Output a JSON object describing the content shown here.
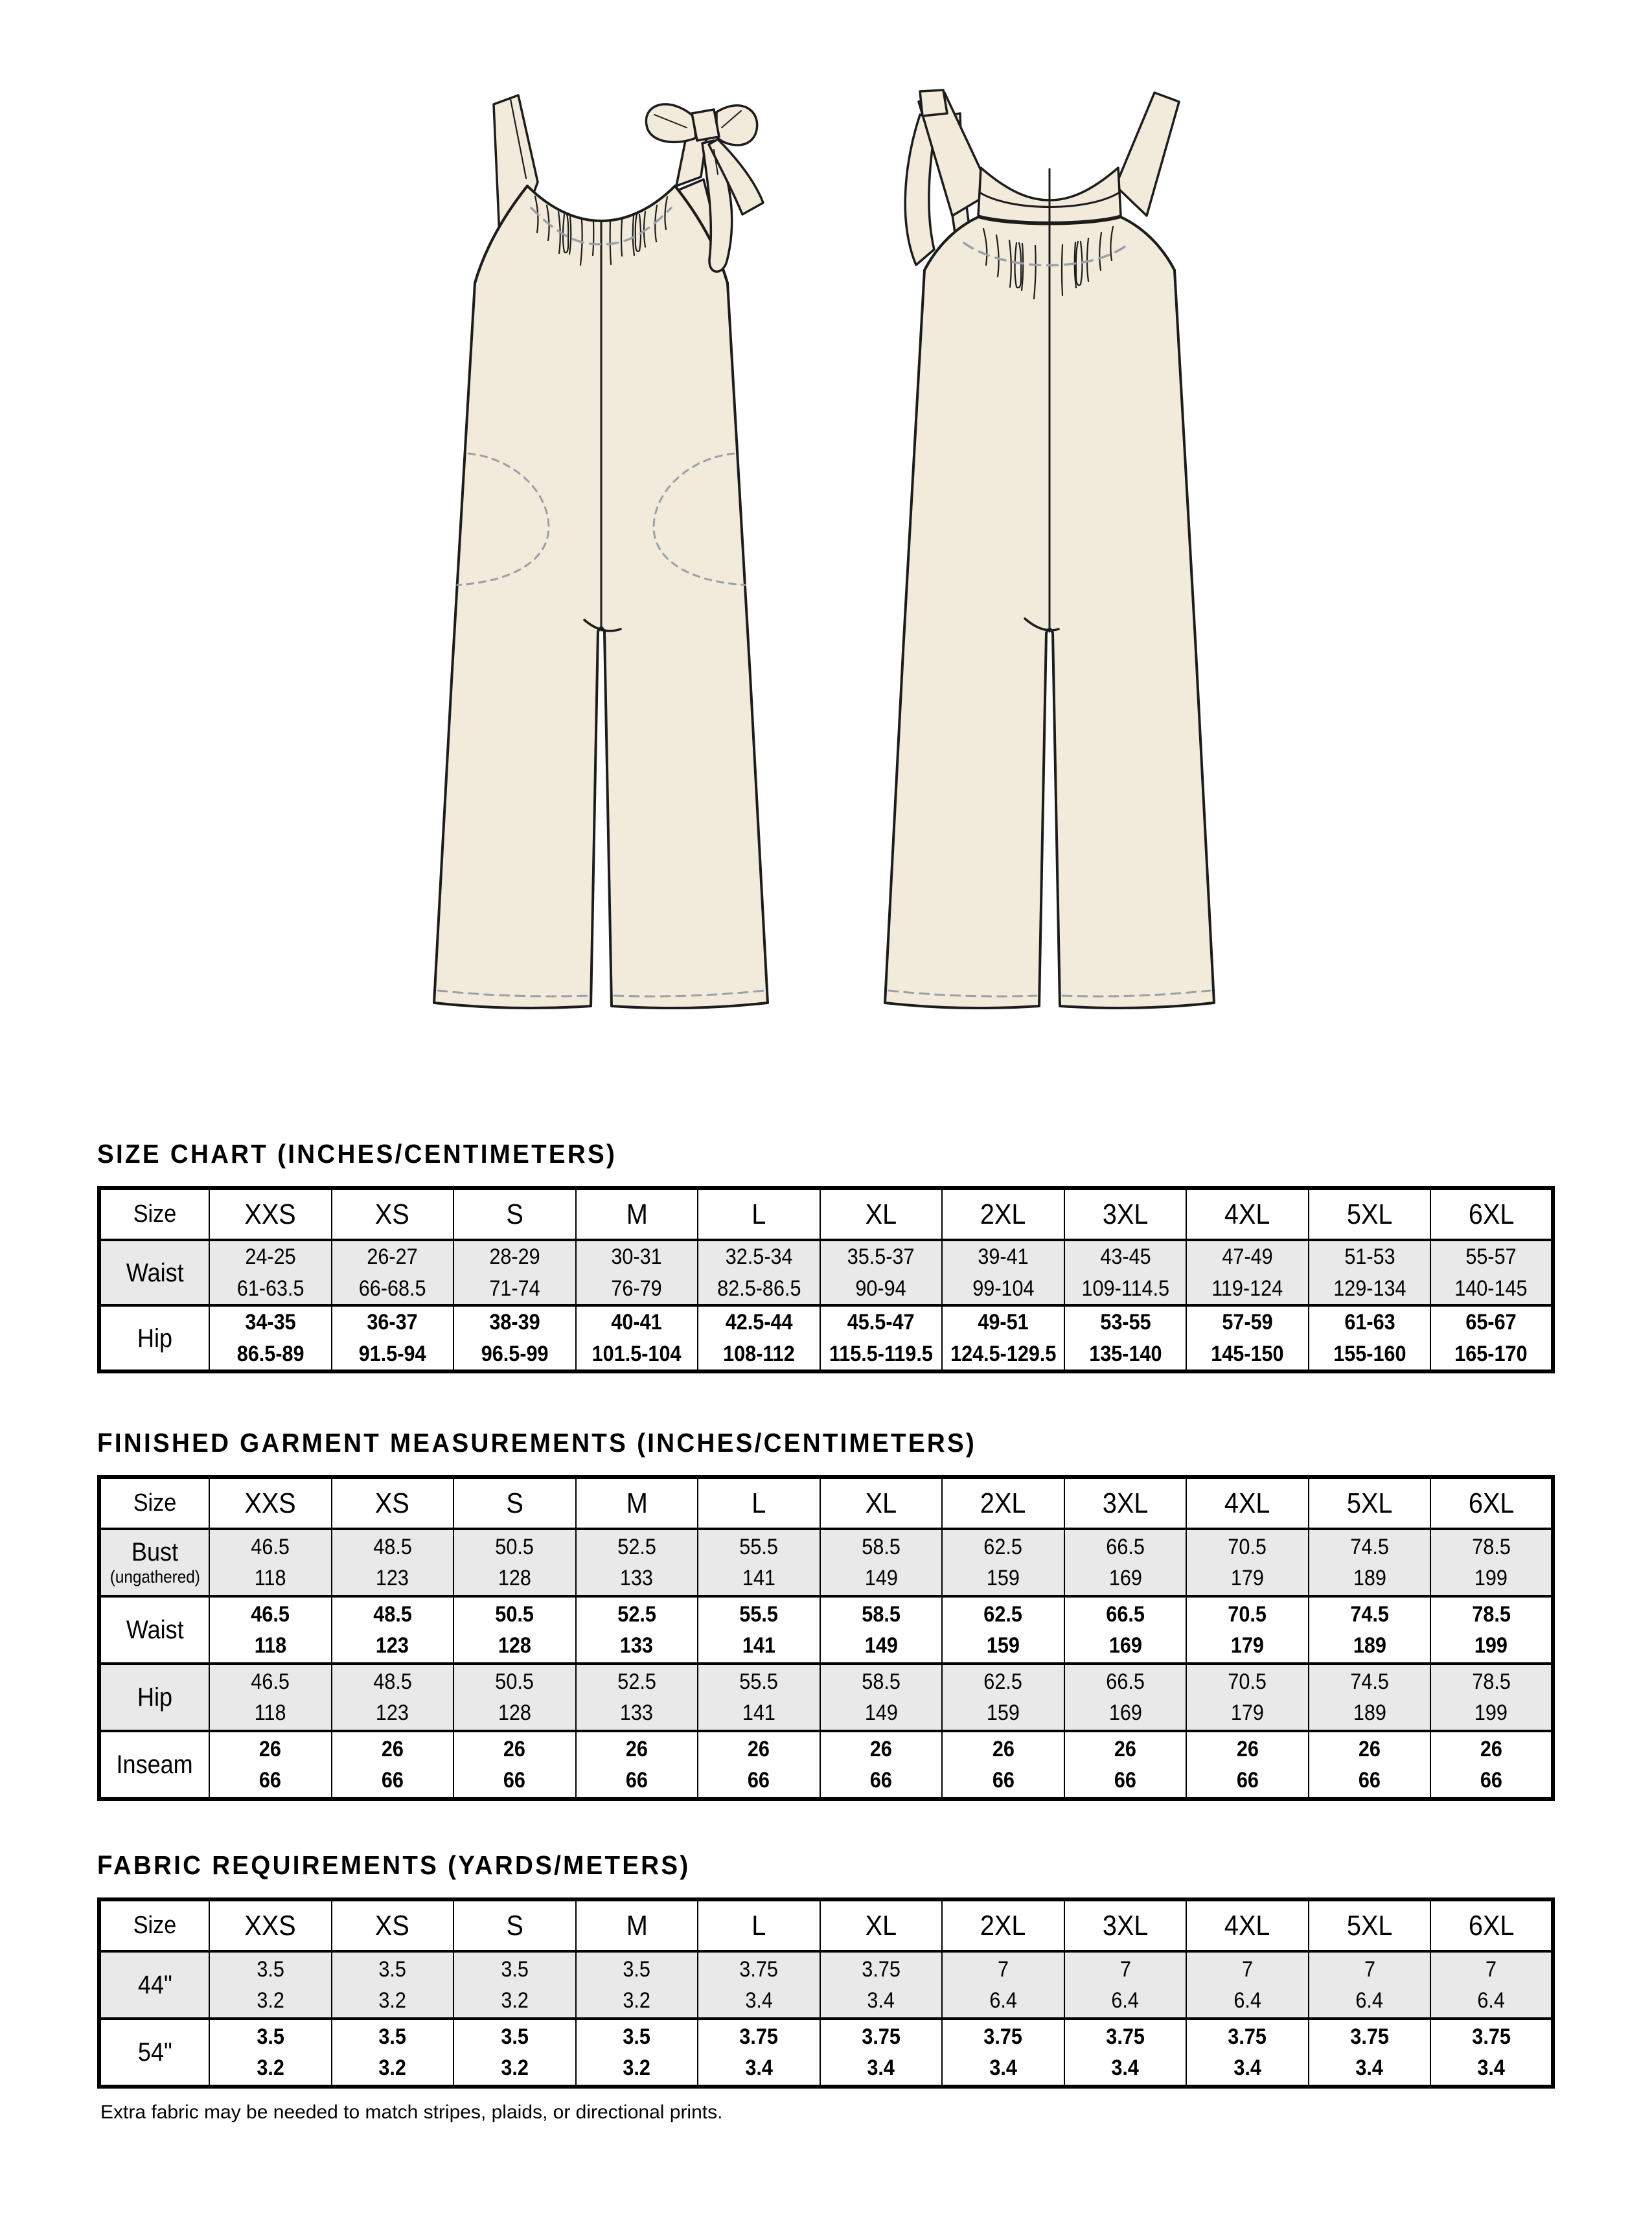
{
  "colors": {
    "fabric": "#F2EBDB",
    "outline": "#1C1C1C",
    "stitch_gray": "#98A0A8",
    "shade": "#E9E9E9"
  },
  "sizes": [
    "XXS",
    "XS",
    "S",
    "M",
    "L",
    "XL",
    "2XL",
    "3XL",
    "4XL",
    "5XL",
    "6XL"
  ],
  "size_chart": {
    "title": "SIZE CHART (INCHES/CENTIMETERS)",
    "header_label": "Size",
    "rows": [
      {
        "label": "Waist",
        "shaded": true,
        "values": [
          [
            "24-25",
            "61-63.5"
          ],
          [
            "26-27",
            "66-68.5"
          ],
          [
            "28-29",
            "71-74"
          ],
          [
            "30-31",
            "76-79"
          ],
          [
            "32.5-34",
            "82.5-86.5"
          ],
          [
            "35.5-37",
            "90-94"
          ],
          [
            "39-41",
            "99-104"
          ],
          [
            "43-45",
            "109-114.5"
          ],
          [
            "47-49",
            "119-124"
          ],
          [
            "51-53",
            "129-134"
          ],
          [
            "55-57",
            "140-145"
          ]
        ]
      },
      {
        "label": "Hip",
        "shaded": false,
        "values": [
          [
            "34-35",
            "86.5-89"
          ],
          [
            "36-37",
            "91.5-94"
          ],
          [
            "38-39",
            "96.5-99"
          ],
          [
            "40-41",
            "101.5-104"
          ],
          [
            "42.5-44",
            "108-112"
          ],
          [
            "45.5-47",
            "115.5-119.5"
          ],
          [
            "49-51",
            "124.5-129.5"
          ],
          [
            "53-55",
            "135-140"
          ],
          [
            "57-59",
            "145-150"
          ],
          [
            "61-63",
            "155-160"
          ],
          [
            "65-67",
            "165-170"
          ]
        ]
      }
    ]
  },
  "finished_garment": {
    "title": "FINISHED GARMENT MEASUREMENTS (INCHES/CENTIMETERS)",
    "header_label": "Size",
    "rows": [
      {
        "label": "Bust",
        "sublabel": "(ungathered)",
        "shaded": true,
        "values": [
          [
            "46.5",
            "118"
          ],
          [
            "48.5",
            "123"
          ],
          [
            "50.5",
            "128"
          ],
          [
            "52.5",
            "133"
          ],
          [
            "55.5",
            "141"
          ],
          [
            "58.5",
            "149"
          ],
          [
            "62.5",
            "159"
          ],
          [
            "66.5",
            "169"
          ],
          [
            "70.5",
            "179"
          ],
          [
            "74.5",
            "189"
          ],
          [
            "78.5",
            "199"
          ]
        ]
      },
      {
        "label": "Waist",
        "shaded": false,
        "values": [
          [
            "46.5",
            "118"
          ],
          [
            "48.5",
            "123"
          ],
          [
            "50.5",
            "128"
          ],
          [
            "52.5",
            "133"
          ],
          [
            "55.5",
            "141"
          ],
          [
            "58.5",
            "149"
          ],
          [
            "62.5",
            "159"
          ],
          [
            "66.5",
            "169"
          ],
          [
            "70.5",
            "179"
          ],
          [
            "74.5",
            "189"
          ],
          [
            "78.5",
            "199"
          ]
        ]
      },
      {
        "label": "Hip",
        "shaded": true,
        "values": [
          [
            "46.5",
            "118"
          ],
          [
            "48.5",
            "123"
          ],
          [
            "50.5",
            "128"
          ],
          [
            "52.5",
            "133"
          ],
          [
            "55.5",
            "141"
          ],
          [
            "58.5",
            "149"
          ],
          [
            "62.5",
            "159"
          ],
          [
            "66.5",
            "169"
          ],
          [
            "70.5",
            "179"
          ],
          [
            "74.5",
            "189"
          ],
          [
            "78.5",
            "199"
          ]
        ]
      },
      {
        "label": "Inseam",
        "shaded": false,
        "values": [
          [
            "26",
            "66"
          ],
          [
            "26",
            "66"
          ],
          [
            "26",
            "66"
          ],
          [
            "26",
            "66"
          ],
          [
            "26",
            "66"
          ],
          [
            "26",
            "66"
          ],
          [
            "26",
            "66"
          ],
          [
            "26",
            "66"
          ],
          [
            "26",
            "66"
          ],
          [
            "26",
            "66"
          ],
          [
            "26",
            "66"
          ]
        ]
      }
    ]
  },
  "fabric_requirements": {
    "title": "FABRIC REQUIREMENTS (YARDS/METERS)",
    "header_label": "Size",
    "rows": [
      {
        "label": "44\"",
        "shaded": true,
        "values": [
          [
            "3.5",
            "3.2"
          ],
          [
            "3.5",
            "3.2"
          ],
          [
            "3.5",
            "3.2"
          ],
          [
            "3.5",
            "3.2"
          ],
          [
            "3.75",
            "3.4"
          ],
          [
            "3.75",
            "3.4"
          ],
          [
            "7",
            "6.4"
          ],
          [
            "7",
            "6.4"
          ],
          [
            "7",
            "6.4"
          ],
          [
            "7",
            "6.4"
          ],
          [
            "7",
            "6.4"
          ]
        ]
      },
      {
        "label": "54\"",
        "shaded": false,
        "values": [
          [
            "3.5",
            "3.2"
          ],
          [
            "3.5",
            "3.2"
          ],
          [
            "3.5",
            "3.2"
          ],
          [
            "3.5",
            "3.2"
          ],
          [
            "3.75",
            "3.4"
          ],
          [
            "3.75",
            "3.4"
          ],
          [
            "3.75",
            "3.4"
          ],
          [
            "3.75",
            "3.4"
          ],
          [
            "3.75",
            "3.4"
          ],
          [
            "3.75",
            "3.4"
          ],
          [
            "3.75",
            "3.4"
          ]
        ]
      }
    ]
  },
  "footnote": "Extra fabric may be needed to match stripes, plaids, or directional prints."
}
